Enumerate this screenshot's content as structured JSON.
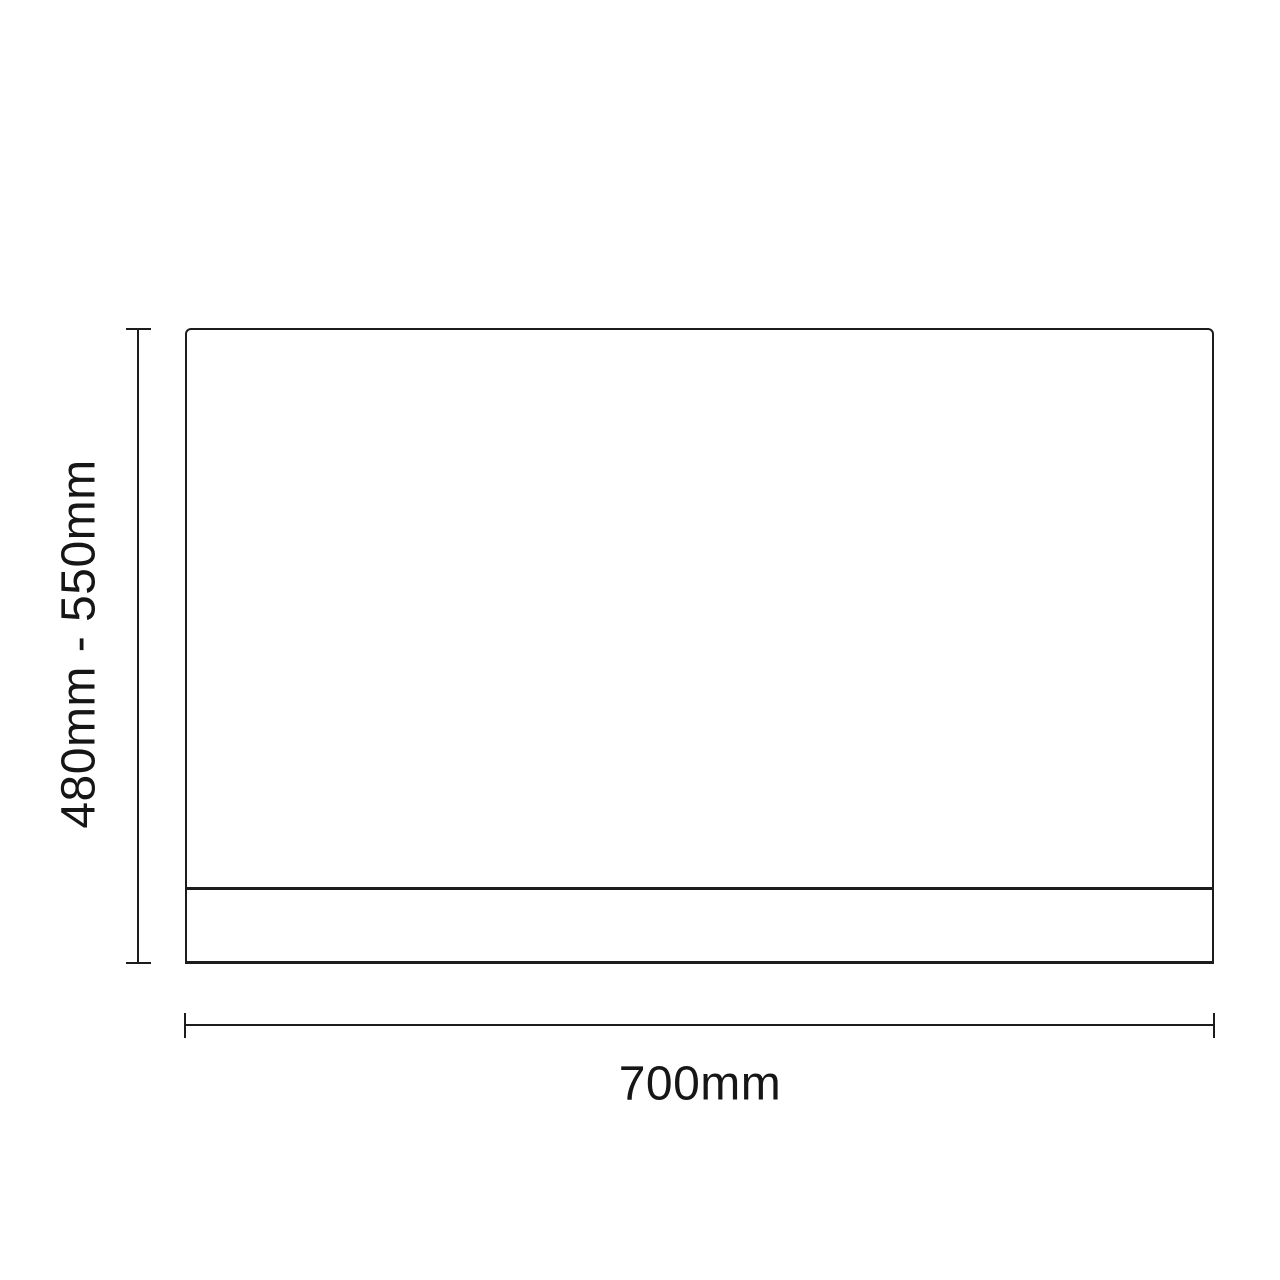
{
  "diagram": {
    "type": "technical-dimension-drawing",
    "dimensions": {
      "height_label": "480mm - 550mm",
      "width_label": "700mm"
    },
    "colors": {
      "line": "#1c1c1c",
      "text": "#161616",
      "background": "#ffffff"
    }
  }
}
